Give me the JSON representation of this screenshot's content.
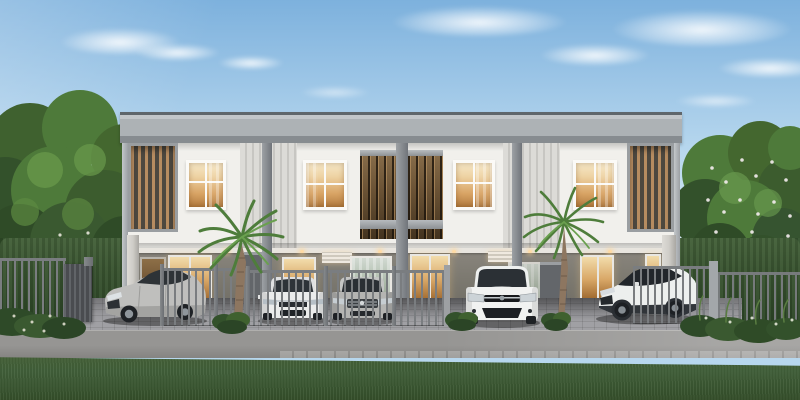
{
  "scene": {
    "description": "Daytime architectural rendering of a modern two-story flat-roof townhouse row with carports, gray bar fence, palm trees, lawn and road in the foreground",
    "time_of_day": "day",
    "sky": "blue with wispy clouds and sun glow from upper left"
  },
  "building": {
    "stories": 2,
    "style": "modern flat-roof townhouse row",
    "upper_windows": 4,
    "central_balcony_with_wood_slats": true,
    "end_slat_screens": 2,
    "ribbed_accent_panels": 2,
    "lit_warm_interiors": true,
    "ground_floor": "recessed gray carport level with glass doors and downlights"
  },
  "vehicles": [
    {
      "id": "car-1",
      "body": "sedan",
      "color_name": "silver",
      "orientation": "three-quarter front, facing left"
    },
    {
      "id": "car-2",
      "body": "sedan",
      "color_name": "white",
      "orientation": "front view, behind fence"
    },
    {
      "id": "car-3",
      "body": "sedan",
      "color_name": "gray",
      "orientation": "front view, behind fence"
    },
    {
      "id": "car-4",
      "body": "hatchback",
      "color_name": "white",
      "orientation": "front view, open gate"
    },
    {
      "id": "car-5",
      "body": "crossover SUV",
      "color_name": "white with dark roof",
      "orientation": "three-quarter front, facing left, behind gate"
    }
  ],
  "landscape": {
    "palm_trees": 2,
    "shade_trees_left": true,
    "flowering_tree_right": true,
    "front_hedges": true,
    "shrubs_along_driveway": true,
    "lawn_foreground": true,
    "paver_driveway": true,
    "gray_bar_fence_with_gates": true
  },
  "palette": {
    "skyTop": "#7db1dd",
    "skyMid": "#b7d7ee",
    "skyLow": "#e3f0f8",
    "roofTop": "#5f666b",
    "roofFace": "#adb2b5",
    "roofShade": "#878c90",
    "facade": "#f1f0ec",
    "ribbedLight": "#dcdbd7",
    "ribbedDark": "#c7c6c2",
    "slatWood": "#b68c60",
    "slatBg": "#4d483f",
    "slatFrame": "#9a9ea1",
    "windowFrame": "#fbfaf7",
    "glowLight": "#eed3a4",
    "glowDeep": "#b17a3e",
    "floorWall": "#8a867e",
    "floorWallDark": "#6e6b63",
    "ceiling": "#e8e5df",
    "column": "#8c9094",
    "columnLight": "#cfcdc8",
    "partition": "#63666a",
    "fence": "#7a7d80",
    "fencePost": "#6b6e72",
    "gateSolid": "#54575b",
    "paver": "#a0a0a4",
    "road": "#969593",
    "roadDark": "#858482",
    "grass": "#466238",
    "grassDark": "#354f2a",
    "hedge": "#3a5531",
    "treeGreen": "#4e7a3a",
    "treeLight": "#699a4b",
    "treeDark": "#2f4b27",
    "trunk": "#7a5e43",
    "palmGreen": "#4e7d3b",
    "palmLight": "#6aa04f",
    "carSilver": "#bfbfbd",
    "carWhite": "#f1f2f1",
    "carGray": "#b4b4b2",
    "glass": "#2d3237",
    "wheel": "#1f2226"
  }
}
